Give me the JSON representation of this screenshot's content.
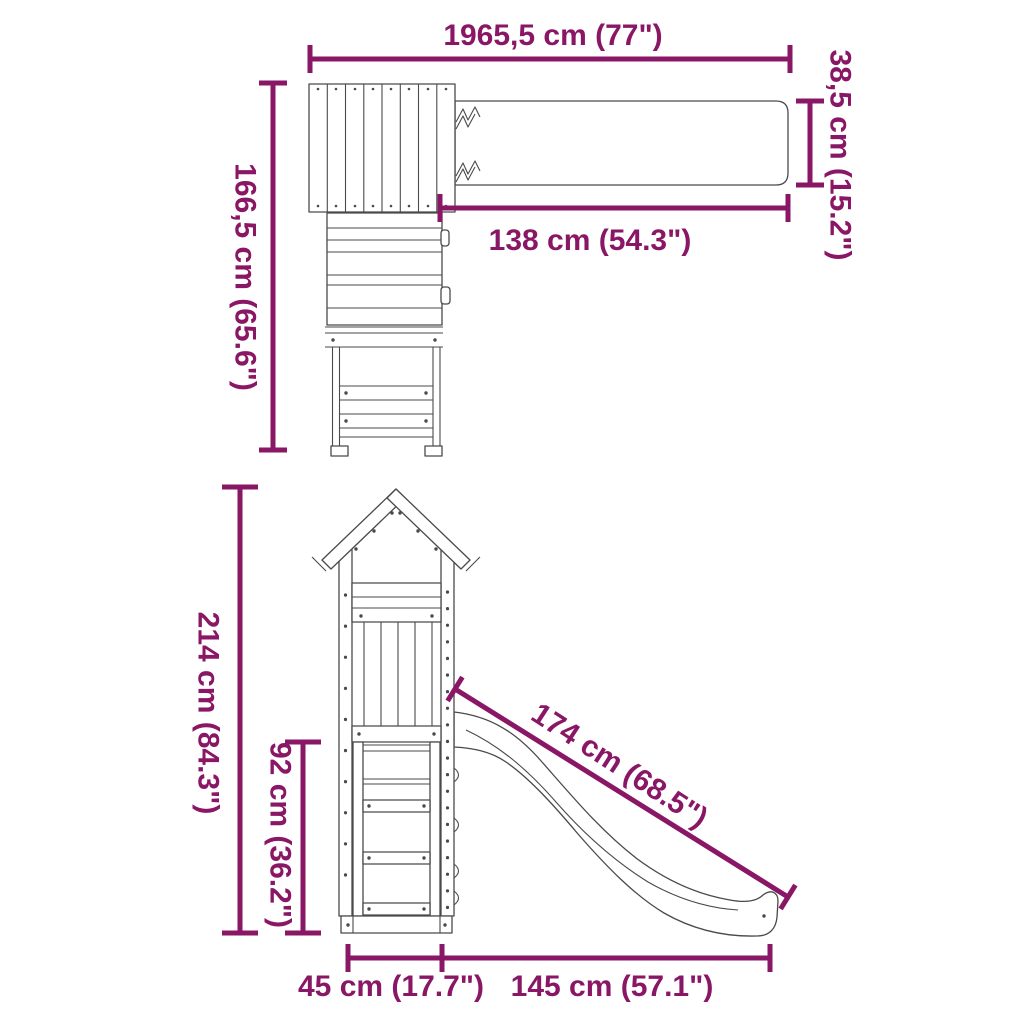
{
  "colors": {
    "accent": "#8A1765",
    "line": "#4a4a4a"
  },
  "dimensions": {
    "overall_length": "1965,5 cm (77\")",
    "beam_width": "38,5 cm (15.2\")",
    "top_depth": "166,5 cm (65.6\")",
    "beam_clear_length": "138 cm (54.3\")",
    "total_height": "214 cm (84.3\")",
    "platform_height": "92 cm (36.2\")",
    "slide_length": "174 cm (68.5\")",
    "base_depth": "45 cm (17.7\")",
    "slide_span": "145 cm (57.1\")"
  }
}
